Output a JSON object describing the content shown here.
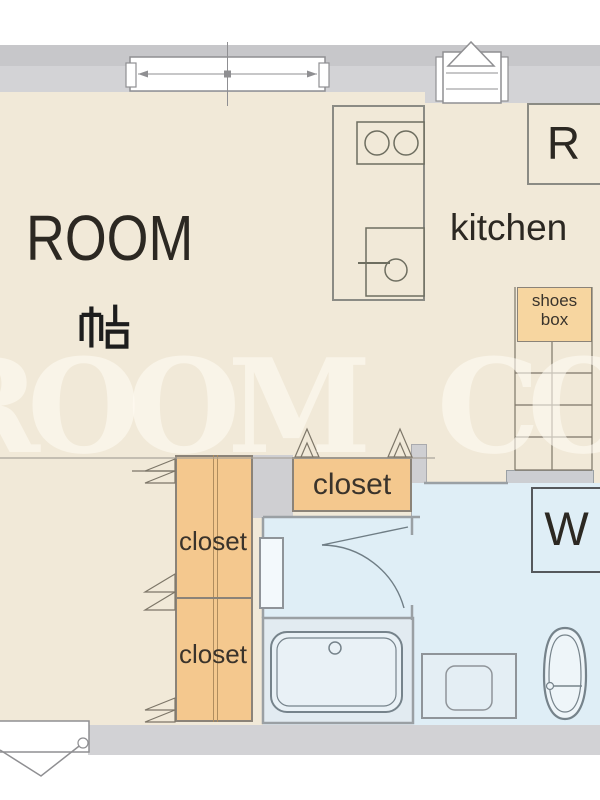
{
  "labels": {
    "room": "ROOM",
    "room_size": "帖",
    "kitchen": "kitchen",
    "refrigerator": "R",
    "washer": "W",
    "shoes_box_line1": "shoes",
    "shoes_box_line2": "box",
    "closet_hall": "closet",
    "closet_left_top": "closet",
    "closet_left_bottom": "closet"
  },
  "watermark": {
    "text": "ROOM CORP"
  },
  "colors": {
    "floor_beige": "#f1e9d8",
    "wall_gray": "#d3d3d6",
    "wall_gray_dark": "#c7c7ca",
    "water_blue": "#dfeef6",
    "bathroom_blue": "#e2ebf1",
    "closet_orange": "#f4c88e",
    "shoes_box_orange": "#f7d6a0",
    "outline_dark": "#8b8378",
    "fixture_line": "#76838b",
    "text_dark": "#2c2822"
  }
}
